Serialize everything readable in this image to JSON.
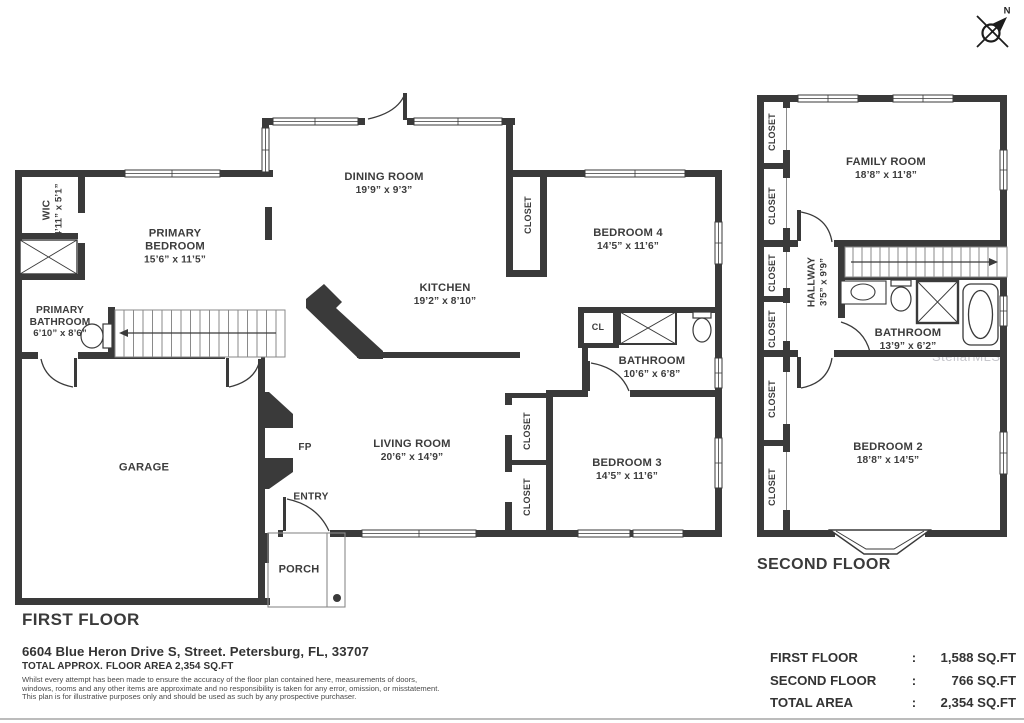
{
  "compass": {
    "north": "N"
  },
  "watermark": "StellarMLS",
  "floors": {
    "first": {
      "title": "FIRST FLOOR",
      "rooms": {
        "wic": {
          "name": "WIC",
          "dims": "4’11” x 5’1”"
        },
        "primary_bedroom": {
          "name": "PRIMARY BEDROOM",
          "dims": "15’6” x 11’5”"
        },
        "primary_bathroom": {
          "name": "PRIMARY BATHROOM",
          "dims": "6’10” x 8’6”"
        },
        "dining_room": {
          "name": "DINING ROOM",
          "dims": "19’9” x 9’3”"
        },
        "kitchen": {
          "name": "KITCHEN",
          "dims": "19’2” x 8’10”"
        },
        "closet_dining": {
          "name": "CLOSET"
        },
        "bedroom4": {
          "name": "BEDROOM 4",
          "dims": "14’5” x 11’6”"
        },
        "cl": {
          "name": "CL"
        },
        "bathroom": {
          "name": "BATHROOM",
          "dims": "10’6” x 6’8”"
        },
        "living_room": {
          "name": "LIVING ROOM",
          "dims": "20’6” x 14’9”"
        },
        "closet_living_1": {
          "name": "CLOSET"
        },
        "closet_living_2": {
          "name": "CLOSET"
        },
        "bedroom3": {
          "name": "BEDROOM 3",
          "dims": "14’5” x 11’6”"
        },
        "garage": {
          "name": "GARAGE"
        },
        "fireplace": {
          "name": "FP"
        },
        "entry": {
          "name": "ENTRY"
        },
        "porch": {
          "name": "PORCH"
        }
      }
    },
    "second": {
      "title": "SECOND FLOOR",
      "rooms": {
        "family_room": {
          "name": "FAMILY ROOM",
          "dims": "18’8” x 11’8”"
        },
        "hallway": {
          "name": "HALLWAY",
          "dims": "3’5” x 9’9”"
        },
        "bathroom": {
          "name": "BATHROOM",
          "dims": "13’9” x 6’2”"
        },
        "bedroom2": {
          "name": "BEDROOM 2",
          "dims": "18’8” x 14’5”"
        },
        "closet_1": {
          "name": "CLOSET"
        },
        "closet_2": {
          "name": "CLOSET"
        },
        "closet_3": {
          "name": "CLOSET"
        },
        "closet_4": {
          "name": "CLOSET"
        },
        "closet_5": {
          "name": "CLOSET"
        },
        "closet_6": {
          "name": "CLOSET"
        }
      }
    }
  },
  "footer": {
    "address": "6604 Blue Heron Drive S, Street. Petersburg, FL, 33707",
    "total_line": "TOTAL APPROX. FLOOR AREA 2,354 SQ.FT",
    "disclaimer_1": "Whilst every attempt has been made to ensure the accuracy of the floor plan contained here, measurements of doors,",
    "disclaimer_2": "windows, rooms and any other items are approximate and no responsibility is taken for any error, omission, or misstatement.",
    "disclaimer_3": "This plan is for illustrative purposes only and should be used as such by any prospective purchaser.",
    "summary": {
      "rows": [
        {
          "label": "FIRST FLOOR",
          "sep": ":",
          "value": "1,588 SQ.FT"
        },
        {
          "label": "SECOND FLOOR",
          "sep": ":",
          "value": "766 SQ.FT"
        },
        {
          "label": "TOTAL AREA",
          "sep": ":",
          "value": "2,354 SQ.FT"
        }
      ]
    }
  }
}
